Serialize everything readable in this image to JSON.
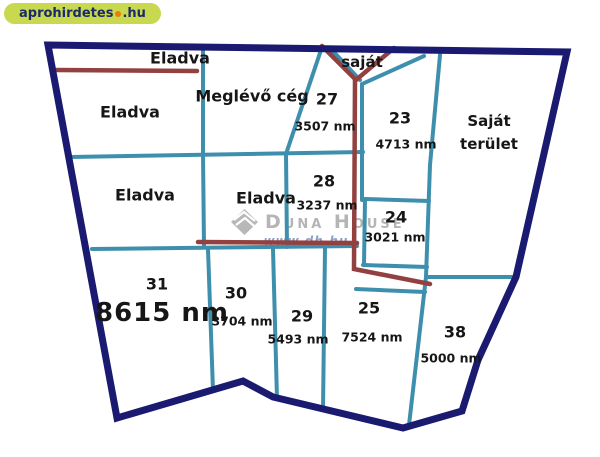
{
  "site_badge": {
    "name": "aprohirdetes",
    "tld": ".hu"
  },
  "watermark": {
    "brand": "Duna House",
    "url": "www.dh.hu"
  },
  "map": {
    "colors": {
      "outer_boundary": "#1a1a70",
      "parcel_line": "#3e8fad",
      "marked_line": "#924040",
      "badge_bg": "#c9d94f",
      "badge_text": "#1b2a6b",
      "badge_dot": "#ef7c00",
      "watermark_grey": "#b5b5b5",
      "watermark_blue": "#8ba3c7"
    },
    "parcels": [
      {
        "key": "eladva-strip",
        "name": "Eladva"
      },
      {
        "key": "eladva-upper-left",
        "name": "Eladva"
      },
      {
        "key": "meglevo-ceg",
        "name": "Meglévő cég"
      },
      {
        "key": "sajat",
        "name": "saját"
      },
      {
        "key": "27",
        "number": "27",
        "area": "3507 nm"
      },
      {
        "key": "23",
        "number": "23",
        "area": "4713 nm"
      },
      {
        "key": "sajat-terulet",
        "name_line1": "Saját",
        "name_line2": "terület"
      },
      {
        "key": "eladva-mid-left",
        "name": "Eladva"
      },
      {
        "key": "eladva-mid",
        "name": "Eladva"
      },
      {
        "key": "28",
        "number": "28",
        "area": "3237 nm"
      },
      {
        "key": "24",
        "number": "24",
        "area": "3021 nm"
      },
      {
        "key": "31",
        "number": "31",
        "area": "8615 nm"
      },
      {
        "key": "30",
        "number": "30",
        "area": "3704 nm"
      },
      {
        "key": "29",
        "number": "29",
        "area": "5493 nm"
      },
      {
        "key": "25",
        "number": "25",
        "area": "7524 nm"
      },
      {
        "key": "38",
        "number": "38",
        "area": "5000 nm"
      }
    ]
  }
}
